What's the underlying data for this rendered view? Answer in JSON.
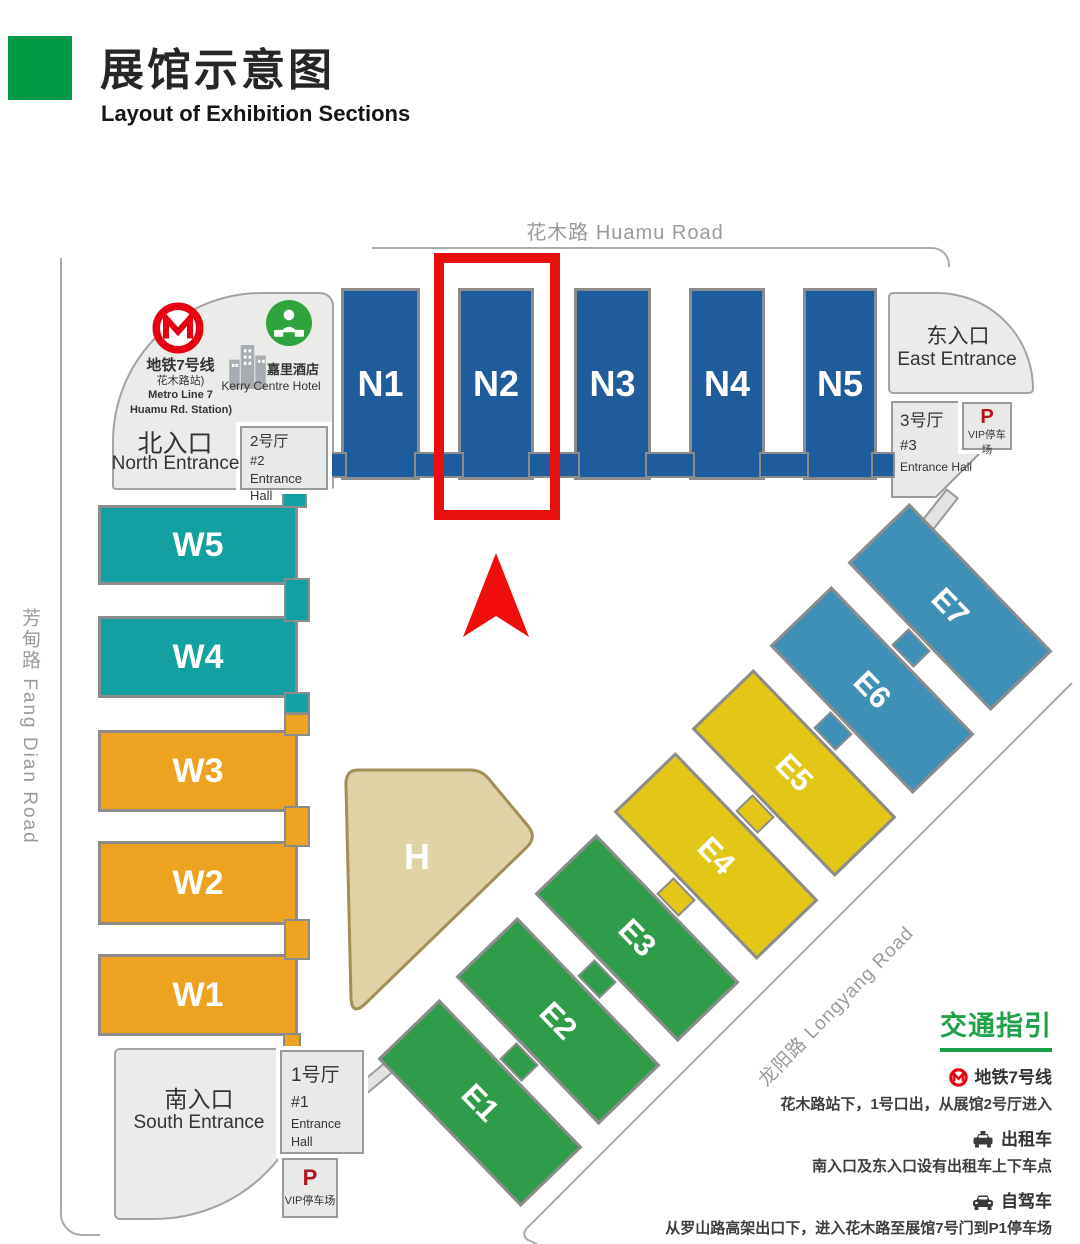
{
  "header": {
    "title_zh": "展馆示意图",
    "title_en": "Layout of Exhibition Sections"
  },
  "roads": {
    "huamu": "花木路 Huamu Road",
    "fangdian": "芳甸路 Fang Dian Road",
    "longyang": "龙阳路  Longyang Road"
  },
  "halls": {
    "N1": "N1",
    "N2": "N2",
    "N3": "N3",
    "N4": "N4",
    "N5": "N5",
    "W1": "W1",
    "W2": "W2",
    "W3": "W3",
    "W4": "W4",
    "W5": "W5",
    "E1": "E1",
    "E2": "E2",
    "E3": "E3",
    "E4": "E4",
    "E5": "E5",
    "E6": "E6",
    "E7": "E7",
    "H": "H"
  },
  "entrances": {
    "north_zh": "北入口",
    "north_en": "North Entrance",
    "east_zh": "东入口",
    "east_en": "East Entrance",
    "south_zh": "南入口",
    "south_en": "South Entrance"
  },
  "entrance_halls": {
    "h1_zh": "1号厅",
    "h1_num": "#1",
    "h1_en": "Entrance Hall",
    "h2_zh": "2号厅",
    "h2_num": "#2",
    "h2_en": "Entrance Hall",
    "h3_zh": "3号厅",
    "h3_num": "#3",
    "h3_en": "Entrance Hall"
  },
  "parking": {
    "symbol": "P",
    "label": "VIP停车场"
  },
  "metro_station": {
    "line_zh": "地铁7号线",
    "station_zh": "花木路站)",
    "line_en": "Metro Line 7",
    "station_en": "Huamu Rd. Station)"
  },
  "hotel": {
    "zh": "嘉里酒店",
    "en": "Kerry Centre Hotel"
  },
  "traffic": {
    "title": "交通指引",
    "items": [
      {
        "icon": "metro-icon",
        "head": "地铁7号线",
        "desc": "花木路站下，1号口出，从展馆2号厅进入"
      },
      {
        "icon": "taxi-icon",
        "head": "出租车",
        "desc": "南入口及东入口设有出租车上下车点"
      },
      {
        "icon": "car-icon",
        "head": "自驾车",
        "desc": "从罗山路高架出口下，进入花木路至展馆7号门到P1停车场"
      }
    ]
  },
  "colors": {
    "n_blue": "#1E5C9C",
    "w_teal": "#13A0A0",
    "w_orange": "#EDA320",
    "e_green": "#2F9C49",
    "e_yellow": "#E2C716",
    "e_steel": "#3E90B6",
    "h_tan": "#DFD2A6",
    "accent_green": "#009A45",
    "traffic_green": "#1FA14A",
    "metro_red": "#E60012",
    "highlight_red": "#E8100C",
    "parking_red": "#B5121B"
  }
}
